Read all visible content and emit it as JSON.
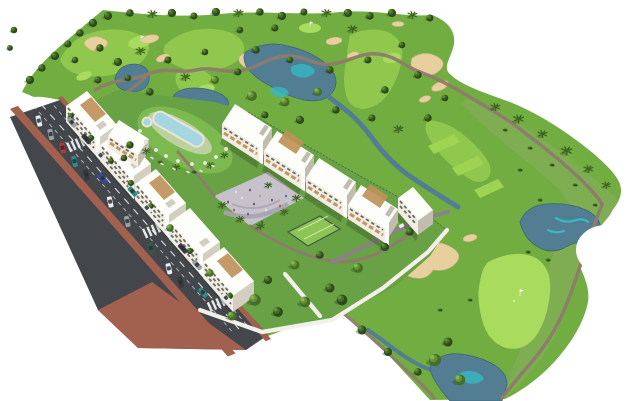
{
  "colors": {
    "bg": "#ffffff",
    "golf_base": "#72ad41",
    "golf_rough": "#7fae52",
    "fairway": "#8fc84d",
    "green_bright": "#a9db5e",
    "tee": "#9fd452",
    "sand": "#e7cf9e",
    "sand_dark": "#cdb37e",
    "water": "#537d93",
    "water_deep": "#3c6377",
    "water_teal": "#35b9c2",
    "path_tan": "#8d7c6c",
    "path_purple": "#8e7f8d",
    "plaza": "#c7c1cb",
    "plaza_edge": "#a9a2b2",
    "lawn": "#68a244",
    "lawn_light": "#7cb94e",
    "pool": "#a5d6e2",
    "deck": "#e7e1d3",
    "court": "#8cc556",
    "court_line": "#dff0c0",
    "fence": "#41524a",
    "wall": "#f3f0e9",
    "road": "#43474b",
    "road_line": "#f5f6f7",
    "sidewalk": "#a2604f",
    "bldg_white": "#fdfdfa",
    "bldg_cream": "#f1ede4",
    "bldg_side": "#d4cec1",
    "bldg_shade": "#c2bcae",
    "window_dark": "#4c483f",
    "wood": "#bf9159",
    "wood_dark": "#97713c",
    "tree_dark": "#2c4a1c",
    "tree_mid": "#456f28",
    "tree_light": "#639337",
    "tree_bright": "#84b84f",
    "palm_frond": "#3e661f",
    "trunk": "#8a7858",
    "shadow": "#1e2d14",
    "car_red": "#ae3a31",
    "car_blue": "#2d4f9e",
    "car_teal": "#2f8b85",
    "car_gray": "#9aa0a5",
    "car_dark": "#363b40",
    "car_white": "#e9ebec",
    "car_green": "#2f5d46",
    "golf_cart": "#f2f3f1",
    "flag": "#f4f4f0"
  }
}
